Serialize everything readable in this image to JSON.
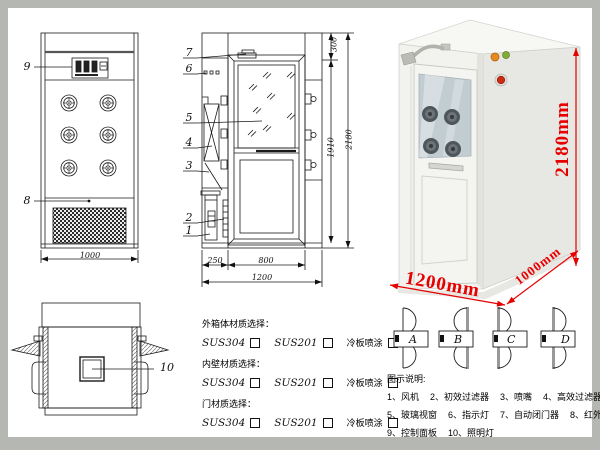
{
  "drawing": {
    "front_view": {
      "callout_panel": "9",
      "callout_grille": "8",
      "dim_width": "1000"
    },
    "side_view": {
      "callouts": [
        "7",
        "6",
        "5",
        "4",
        "3",
        "2",
        "1"
      ],
      "dim_top": "300",
      "dim_door_height": "1910",
      "dim_total_height": "2180",
      "dim_left": "250",
      "dim_door_width": "800",
      "dim_total_width": "1200"
    },
    "top_view": {
      "callout_lamp": "10"
    }
  },
  "photo": {
    "dim_height": "2180mm",
    "dim_width": "1200mm",
    "dim_depth": "1000mm",
    "accent_red": "#e60000"
  },
  "materials": {
    "groups": [
      {
        "title": "外箱体材质选择：",
        "opt1": "SUS304",
        "opt2": "SUS201",
        "opt3": "冷板喷涂"
      },
      {
        "title": "内壁材质选择：",
        "opt1": "SUS304",
        "opt2": "SUS201",
        "opt3": "冷板喷涂"
      },
      {
        "title": "门材质选择：",
        "opt1": "SUS304",
        "opt2": "SUS201",
        "opt3": "冷板喷涂"
      }
    ]
  },
  "door_options": {
    "a": "A",
    "b": "B",
    "c": "C",
    "d": "D"
  },
  "legend": {
    "title": "图示说明:",
    "items": [
      "1、风机",
      "2、初效过滤器",
      "3、喷嘴",
      "4、高效过滤器",
      "5、玻璃视窗",
      "6、指示灯",
      "7、自动闭门器",
      "8、红外线感应器",
      "9、控制面板",
      "10、照明灯"
    ]
  }
}
